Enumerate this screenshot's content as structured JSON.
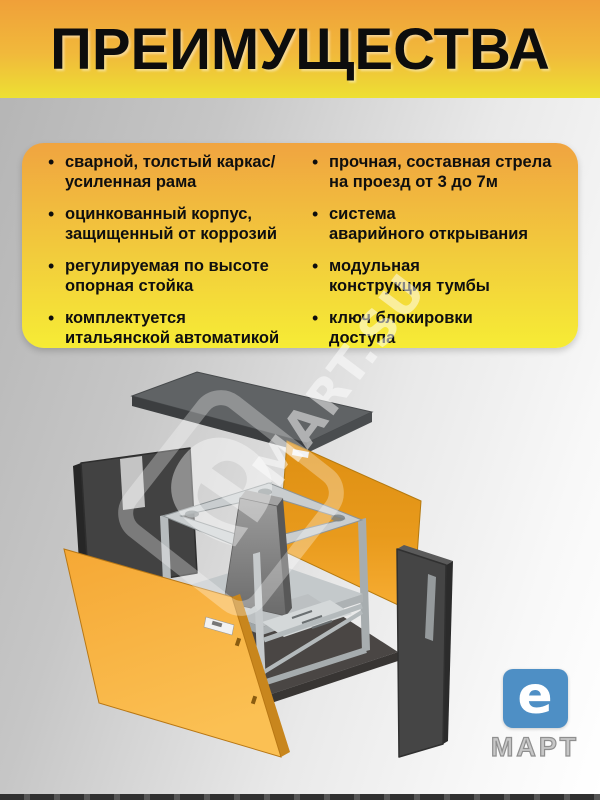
{
  "title": "ПРЕИМУЩЕСТВА",
  "advantages": {
    "left": [
      {
        "text": "сварной, толстый каркас/\nусиленная рама"
      },
      {
        "text": "оцинкованный корпус,\nзащищенный от коррозий"
      },
      {
        "text": "регулируемая по высоте\nопорная стойка"
      },
      {
        "text": "комплектуется\nитальянской автоматикой"
      }
    ],
    "right": [
      {
        "text": "прочная, составная стрела\nна проезд от 3 до 7м"
      },
      {
        "text": "система\nаварийного открывания"
      },
      {
        "text": "модульная\nконструкция тумбы"
      },
      {
        "text": "ключ блокировки\nдоступа"
      }
    ]
  },
  "watermark": {
    "glyph": "е",
    "text": "MART.SU"
  },
  "brand": {
    "logo_letter": "e",
    "logo_name": "МАРТ",
    "logo_color": "#4E8FC5"
  },
  "colors": {
    "banner_orange": "#F0A039",
    "banner_yellow": "#EDE033",
    "card_orange": "#F0A440",
    "card_yellow": "#F6EC35",
    "panel_orange": "#F6A72E",
    "frame_gray": "#C9CDCF",
    "panel_dark": "#454545"
  }
}
